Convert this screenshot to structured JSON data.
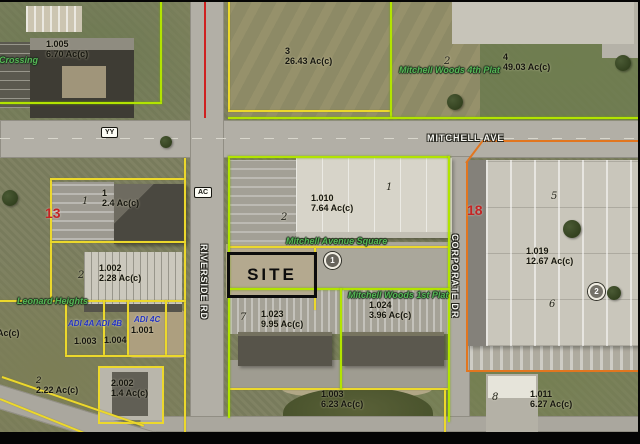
{
  "roads": {
    "mitchell_ave": "MITCHELL AVE",
    "riverside_rd": "RIVERSIDE RD",
    "corporate_dr": "CORPORATE DR",
    "sign_yy": "YY",
    "sign_ac": "AC"
  },
  "site_label": "SITE",
  "plat_names": [
    {
      "text": "de Crossing"
    },
    {
      "text": "Mitchell Woods 4th Plat"
    },
    {
      "text": "Mitchell Avenue Square"
    },
    {
      "text": "Mitchell Woods 1st Plat"
    },
    {
      "text": "Leonard Heights"
    }
  ],
  "parcels": [
    {
      "lot": "1.005",
      "ac": "6.70 Ac(c)"
    },
    {
      "lot": "3",
      "ac": "26.43 Ac(c)"
    },
    {
      "lot": "4",
      "ac": "49.03 Ac(c)"
    },
    {
      "lot": "1",
      "ac": "2.4 Ac(c)"
    },
    {
      "lot": "1.002",
      "ac": "2.28 Ac(c)"
    },
    {
      "lot": "1.010",
      "ac": "7.64 Ac(c)"
    },
    {
      "lot": "1.019",
      "ac": "12.67 Ac(c)"
    },
    {
      "lot": "1.023",
      "ac": "9.95 Ac(c)"
    },
    {
      "lot": "1.024",
      "ac": "3.96 Ac(c)"
    },
    {
      "lot": "2",
      "ac": "2.22 Ac(c)"
    },
    {
      "lot": "2.002",
      "ac": "1.4 Ac(c)"
    },
    {
      "lot": "1.003",
      "ac": "6.23 Ac(c)"
    },
    {
      "lot": "1.011",
      "ac": "6.27 Ac(c)"
    }
  ],
  "small_lots": [
    {
      "lot": "1.003"
    },
    {
      "lot": "1.004"
    },
    {
      "lot": "1.001"
    }
  ],
  "partial_label": "Ac(c)",
  "subdivision_labels": [
    {
      "text": "ADI 4A ADI 4B"
    },
    {
      "text": "ADI 4C"
    }
  ],
  "section_numbers": [
    {
      "text": "13"
    },
    {
      "text": "18"
    }
  ],
  "circle_markers": [
    {
      "text": "1"
    },
    {
      "text": "2"
    }
  ],
  "figure_numbers": [
    {
      "text": "1"
    },
    {
      "text": "2"
    },
    {
      "text": "2"
    },
    {
      "text": "1"
    },
    {
      "text": "2"
    },
    {
      "text": "7"
    },
    {
      "text": "5"
    },
    {
      "text": "6"
    },
    {
      "text": "8"
    }
  ],
  "colors": {
    "parcel_green": "#b2e400",
    "parcel_yellow": "#ecd82c",
    "parcel_orange": "#e2761f",
    "route_red": "#cf2020",
    "plat_name_green": "#56b656",
    "subdivision_blue": "#2534c1",
    "section_red": "#c42424"
  }
}
